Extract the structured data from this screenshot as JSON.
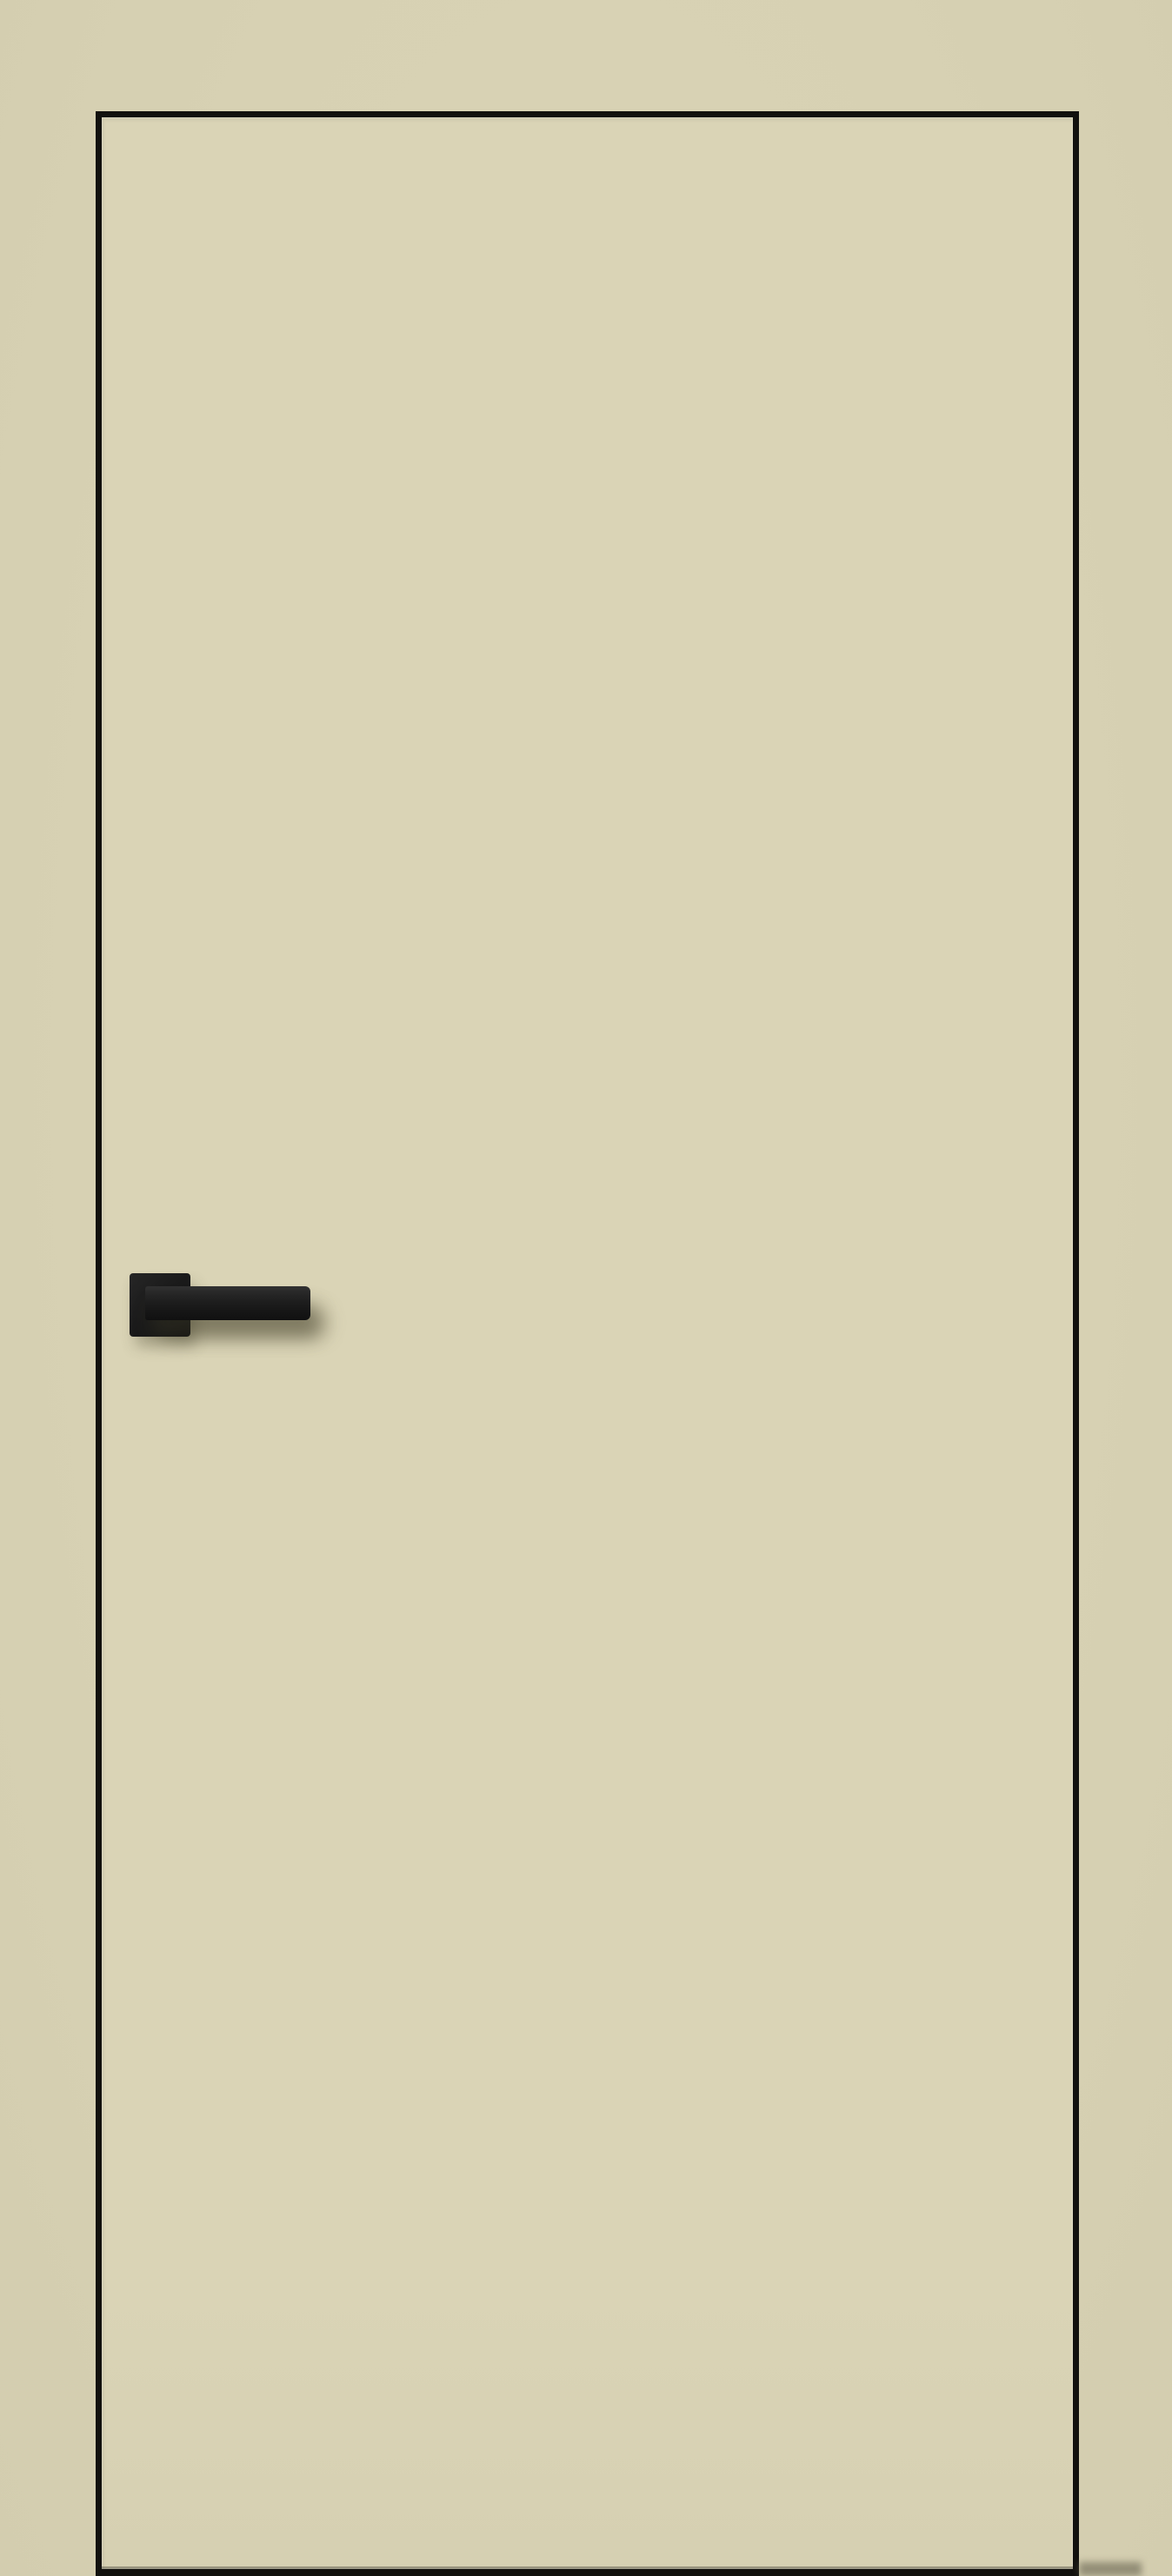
{
  "image": {
    "type": "product-render",
    "subject": "closed interior flush door, front view, cream finish with black edge and black lever handle",
    "colors": {
      "background": "#d7d1b3",
      "background_dark": "#d3cdaf",
      "door_face": "#dad4b6",
      "door_face_low": "#d6d0b2",
      "door_edge": "#12110e",
      "handle": "#1b1b1b",
      "shadow": "rgba(70,65,42,0.40)"
    }
  },
  "door": {
    "style": "flush panel, frameless look, thin black edge band on all four sides",
    "handle": {
      "type": "lever handle on square rosette",
      "finish": "matte black",
      "side": "left",
      "orientation": "lever pointing right"
    },
    "glazing": "none",
    "hinges_visible": "no",
    "keyhole_visible": "no"
  }
}
